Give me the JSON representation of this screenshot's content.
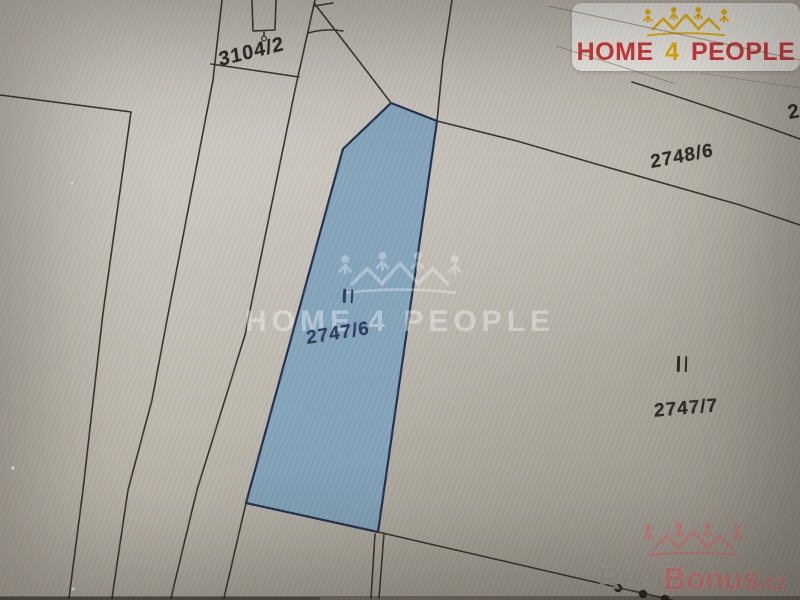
{
  "map": {
    "type": "cadastral-parcel-map",
    "highlight_color": "#7fa3bd",
    "line_color": "#38332c",
    "parcels": [
      {
        "label": "3104/2",
        "highlighted": false
      },
      {
        "label": "2748/6",
        "highlighted": false
      },
      {
        "label": "2747/6",
        "highlighted": true,
        "label_color": "#2c3a5e"
      },
      {
        "label": "2747/7",
        "highlighted": false
      },
      {
        "label": "2",
        "highlighted": false
      }
    ],
    "land_use_symbols": [
      {
        "type": "grassland-mark",
        "parcel": "2747/6"
      },
      {
        "type": "grassland-mark",
        "parcel": "2747/7"
      }
    ]
  },
  "branding": {
    "agency_logo": {
      "home": "HOME",
      "four": "4",
      "people": "PEOPLE",
      "icon": "houses-people-icon",
      "text_color": "#d93338",
      "accent_color": "#f0b400",
      "panel_color": "#f1efe9"
    },
    "center_watermark": {
      "text": "HOME 4 PEOPLE",
      "icon": "houses-people-icon"
    },
    "corner_watermark": {
      "real": "Real",
      "bonus": "Bonus",
      "cz": ".cz",
      "icon": "houses-crown-icon"
    }
  }
}
